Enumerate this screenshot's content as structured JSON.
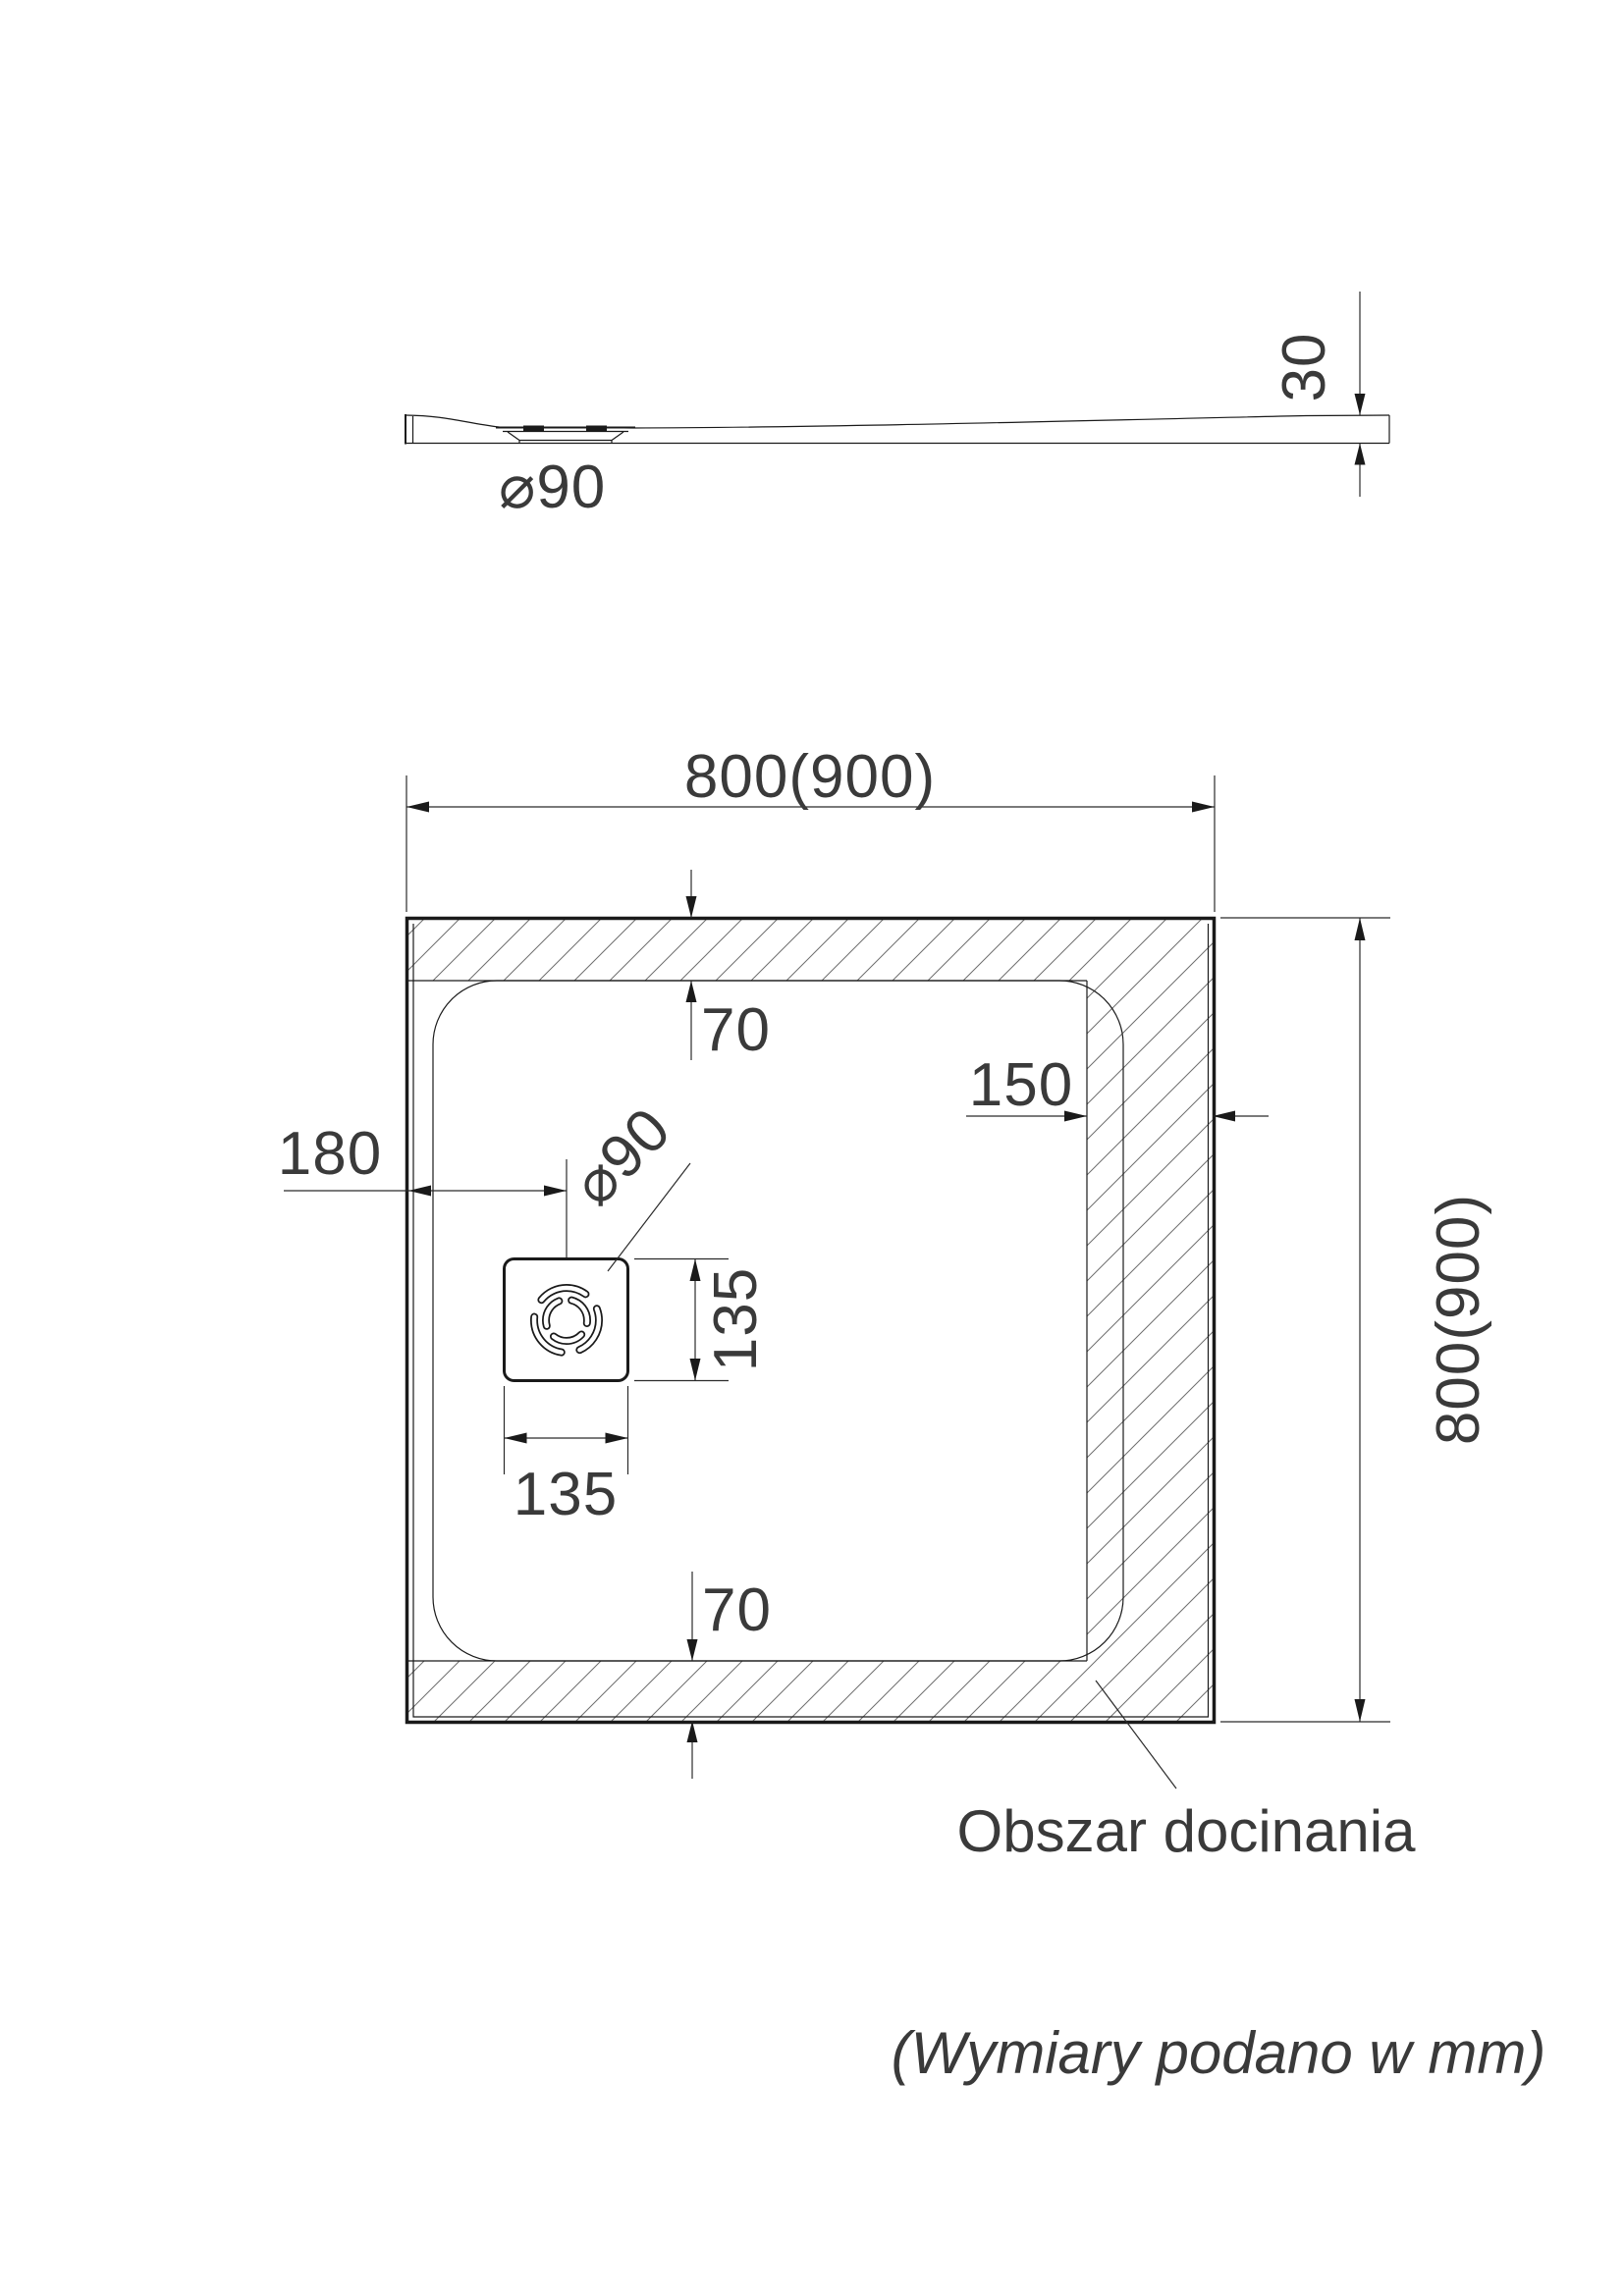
{
  "side_view": {
    "drain_diameter_label": "⌀90",
    "thickness_label": "30"
  },
  "plan_view": {
    "width_label": "800(900)",
    "height_label": "800(900)",
    "top_inset_label": "70",
    "bottom_inset_label": "70",
    "right_inset_label": "150",
    "drain_offset_label": "180",
    "drain_diameter_label": "⌀90",
    "drain_height_label": "135",
    "drain_width_label": "135",
    "trim_area_label": "Obszar docinania"
  },
  "footer": {
    "units_note": "(Wymiary podano w mm)"
  },
  "colors": {
    "line": "#1a1a1a",
    "dimension_text": "#3a3a3a",
    "hatch": "#6e6e6e",
    "background": "#ffffff"
  }
}
